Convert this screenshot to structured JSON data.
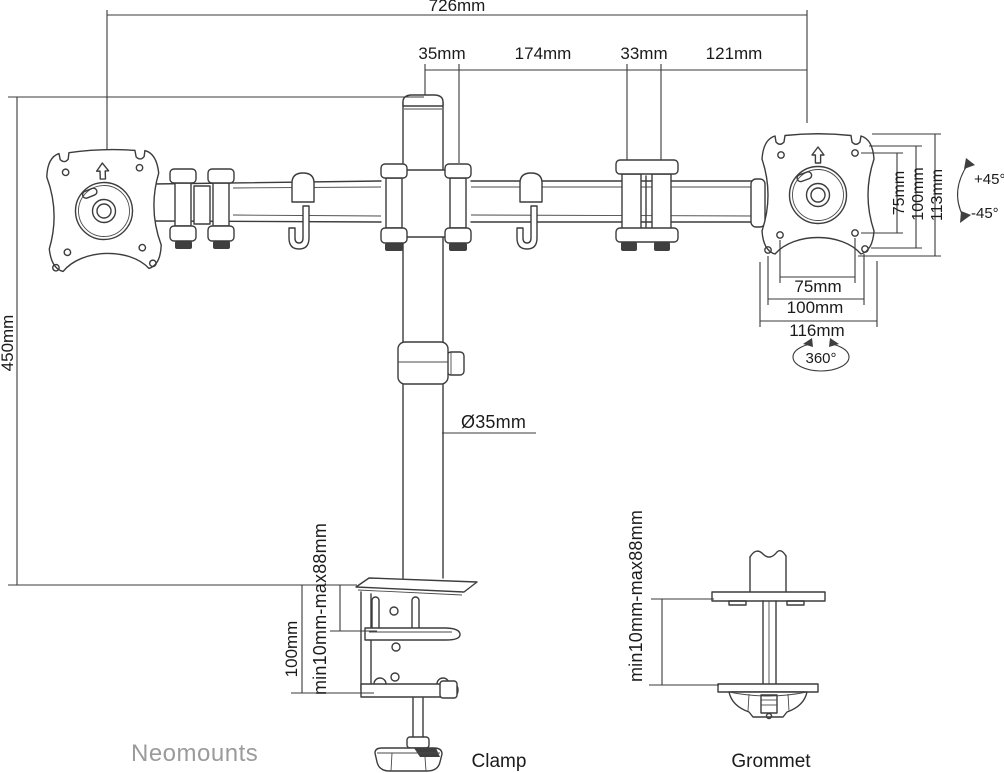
{
  "product": "dual-monitor-desk-mount-diagram",
  "colors": {
    "background": "#ffffff",
    "line": "#3c3c3c",
    "text": "#1b1b1b",
    "brand": "#9b9b9b"
  },
  "brand": {
    "name": "Neomounts"
  },
  "dims": {
    "top_total": "726mm",
    "seg_pole": "35mm",
    "seg_arm": "174mm",
    "seg_joint": "33mm",
    "seg_plate": "121mm",
    "height": "450mm",
    "pole_diameter": "Ø35mm",
    "vesa_v75": "75mm",
    "vesa_v100": "100mm",
    "vesa_v113": "113mm",
    "tilt_up": "+45°",
    "tilt_down": "-45°",
    "vesa_h75": "75mm",
    "vesa_h100": "100mm",
    "vesa_h116": "116mm",
    "swivel": "360°",
    "clamp_height": "100mm",
    "clamp_range": "min10mm-max88mm",
    "grommet_range": "min10mm-max88mm"
  },
  "captions": {
    "clamp": "Clamp",
    "grommet": "Grommet"
  }
}
